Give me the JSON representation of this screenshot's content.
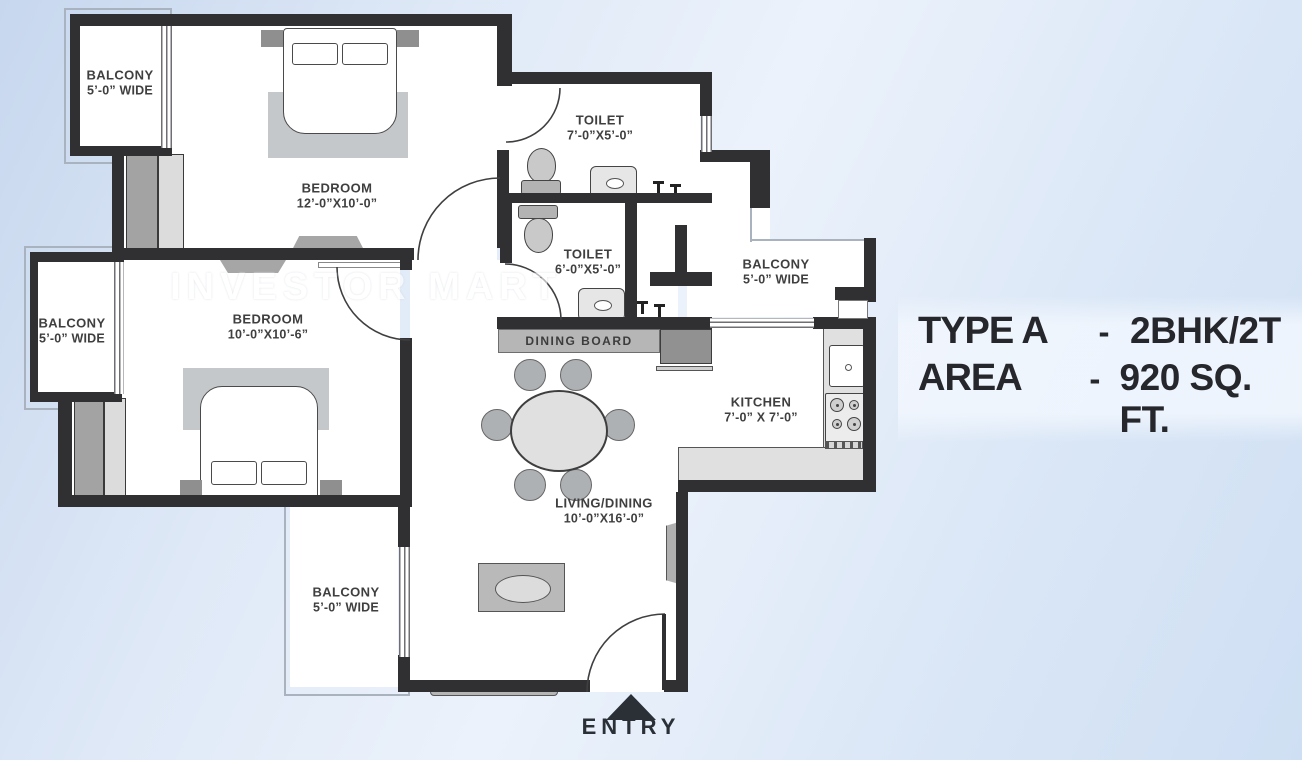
{
  "watermark": {
    "text": "INVESTOR MART"
  },
  "panel": {
    "type_label": "TYPE A",
    "type_dash": "-",
    "type_value": "2BHK/2T",
    "area_label": "AREA",
    "area_dash": "-",
    "area_value": "920 SQ. FT."
  },
  "entry": {
    "label": "ENTRY"
  },
  "rooms": {
    "balcony_top_left": {
      "name": "BALCONY",
      "dims": "5’-0” WIDE"
    },
    "bedroom_top": {
      "name": "BEDROOM",
      "dims": "12’-0”X10’-0”"
    },
    "toilet_attached": {
      "name": "TOILET",
      "dims": "7’-0”X5’-0”"
    },
    "toilet_common": {
      "name": "TOILET",
      "dims": "6’-0”X5’-0”"
    },
    "balcony_right": {
      "name": "BALCONY",
      "dims": "5’-0” WIDE"
    },
    "bedroom_left": {
      "name": "BEDROOM",
      "dims": "10’-0”X10’-6”"
    },
    "balcony_left": {
      "name": "BALCONY",
      "dims": "5’-0” WIDE"
    },
    "kitchen": {
      "name": "KITCHEN",
      "dims": "7’-0” X 7’-0”"
    },
    "living_dining": {
      "name": "LIVING/DINING",
      "dims": "10’-0”X16’-0”"
    },
    "balcony_bottom": {
      "name": "BALCONY",
      "dims": "5’-0” WIDE"
    },
    "dining_board": {
      "name": "DINING BOARD"
    }
  },
  "colors": {
    "wall": "#303033",
    "floor": "#ffffff",
    "background_blue": "#d9e6f6",
    "furniture_gray": "#b5b5b5",
    "label_text": "#3f3f3f",
    "panel_text": "#26272c"
  }
}
